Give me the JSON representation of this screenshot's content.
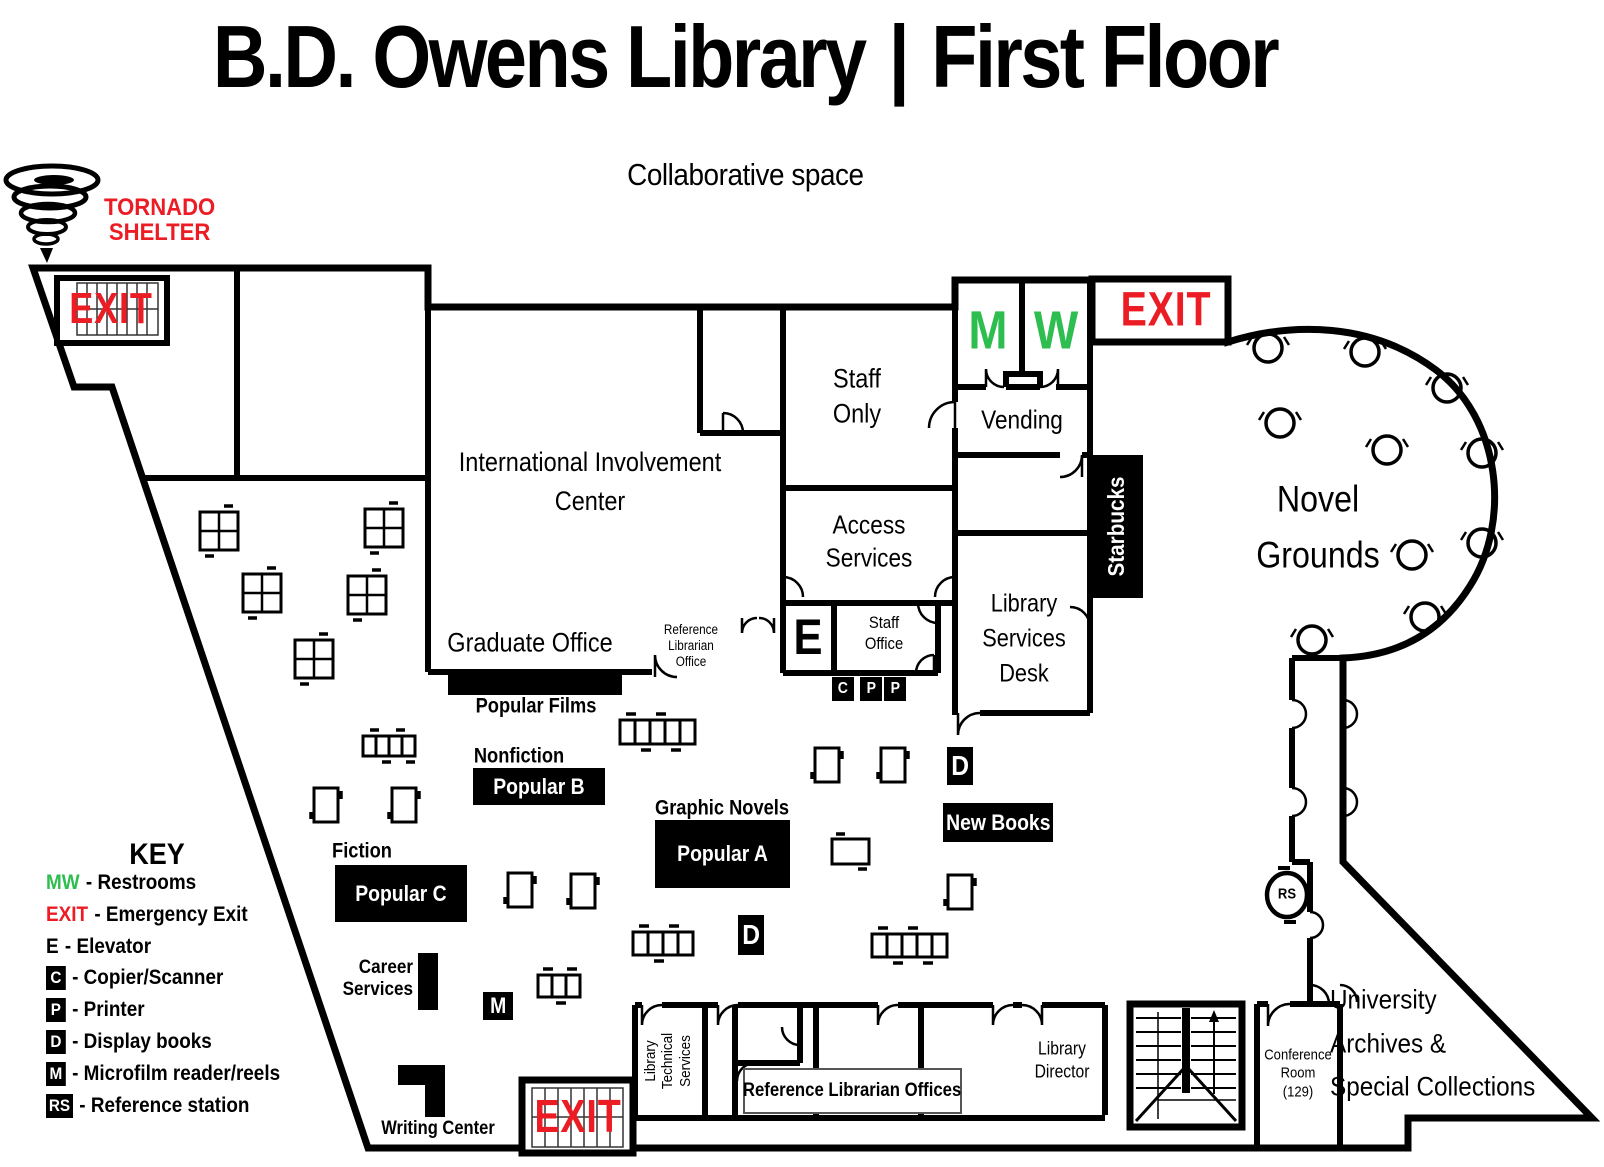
{
  "header": {
    "title_left": "B.D. Owens Library",
    "separator": "|",
    "title_right": "First Floor",
    "subtitle": "Collaborative space"
  },
  "tornado_shelter": {
    "lines": [
      "TORNADO",
      "SHELTER"
    ]
  },
  "colors": {
    "wall": "#000000",
    "exit_red": "#EC1C24",
    "restroom_green": "#2EBD4F"
  },
  "key": {
    "title": "KEY",
    "items": [
      {
        "symbol": "MW",
        "type": "green-text",
        "label": "- Restrooms"
      },
      {
        "symbol": "EXIT",
        "type": "red-text",
        "label": "- Emergency Exit"
      },
      {
        "symbol": "E",
        "type": "plain-text",
        "label": "- Elevator"
      },
      {
        "symbol": "C",
        "type": "black-box",
        "label": "- Copier/Scanner"
      },
      {
        "symbol": "P",
        "type": "black-box",
        "label": "- Printer"
      },
      {
        "symbol": "D",
        "type": "black-box",
        "label": "- Display books"
      },
      {
        "symbol": "M",
        "type": "black-box",
        "label": "- Microfilm reader/reels"
      },
      {
        "symbol": "RS",
        "type": "black-box",
        "label": "- Reference station"
      }
    ]
  },
  "rooms": {
    "staff_only": {
      "lines": [
        "Staff",
        "Only"
      ]
    },
    "vending": {
      "label": "Vending"
    },
    "access_services": {
      "lines": [
        "Access",
        "Services"
      ]
    },
    "international_involvement_center": {
      "lines": [
        "International Involvement",
        "Center"
      ]
    },
    "graduate_office": {
      "label": "Graduate Office"
    },
    "reference_librarian_office": {
      "lines": [
        "Reference",
        "Librarian",
        "Office"
      ]
    },
    "staff_office": {
      "lines": [
        "Staff",
        "Office"
      ]
    },
    "library_services_desk": {
      "lines": [
        "Library",
        "Services",
        "Desk"
      ]
    },
    "novel_grounds": {
      "lines": [
        "Novel",
        "Grounds"
      ]
    },
    "library_technical_services": {
      "lines": [
        "Library",
        "Technical",
        "Services"
      ]
    },
    "reference_librarian_offices": {
      "label": "Reference Librarian Offices"
    },
    "library_director": {
      "lines": [
        "Library",
        "Director"
      ]
    },
    "conference_room": {
      "lines": [
        "Conference",
        "Room",
        "(129)"
      ]
    },
    "university_archives": {
      "lines": [
        "University",
        "Archives &",
        "Special Collections"
      ]
    },
    "writing_center": {
      "label": "Writing Center"
    },
    "career_services": {
      "lines": [
        "Career",
        "Services"
      ]
    }
  },
  "areas": {
    "popular_films": {
      "label": "Popular Films"
    },
    "nonfiction": {
      "label": "Nonfiction",
      "box": "Popular B"
    },
    "fiction": {
      "label": "Fiction",
      "box": "Popular C"
    },
    "graphic_novels": {
      "label": "Graphic Novels",
      "box": "Popular A"
    },
    "new_books": {
      "label": "New Books"
    },
    "starbucks": {
      "label": "Starbucks"
    }
  },
  "signs": {
    "exit": "EXIT",
    "restroom_men": "M",
    "restroom_women": "W",
    "elevator": "E",
    "copier": "C",
    "printer": "P",
    "display_books": "D",
    "microfilm": "M",
    "reference_station": "RS"
  }
}
